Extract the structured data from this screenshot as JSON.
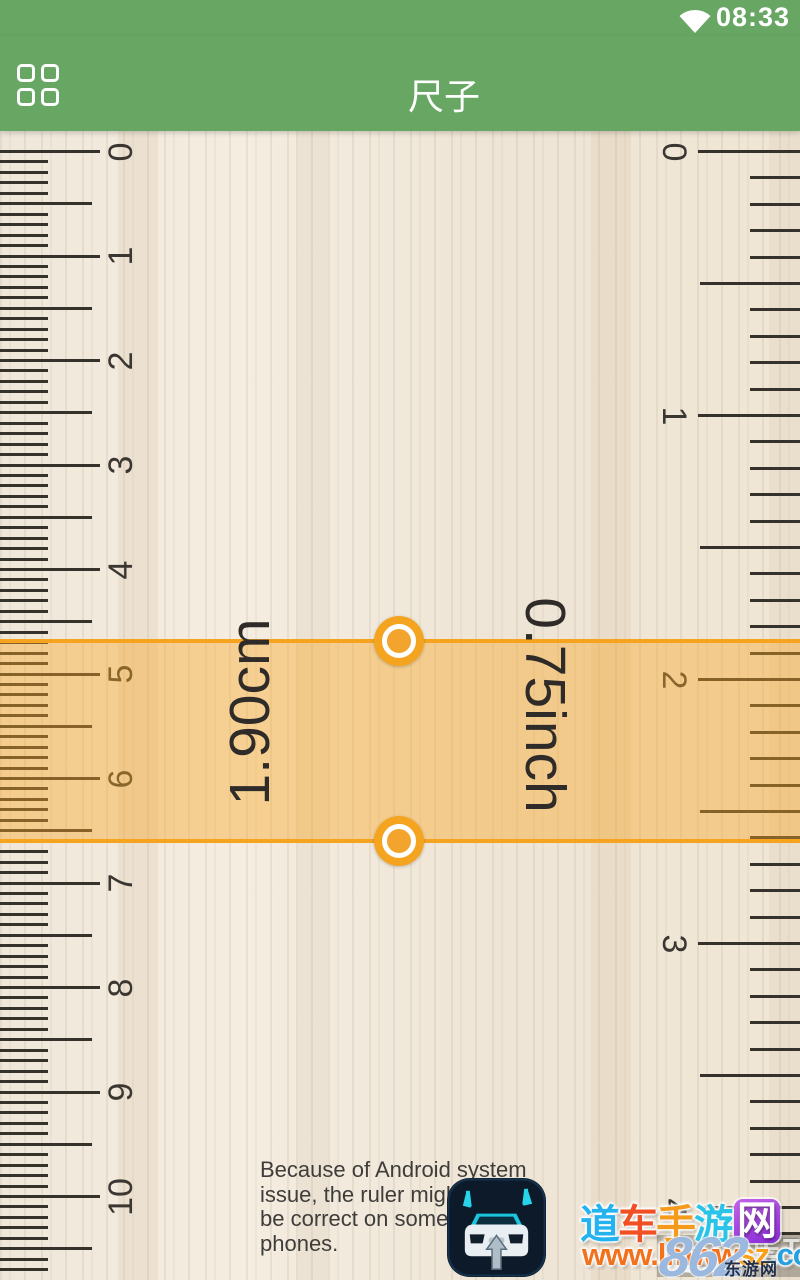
{
  "colors": {
    "header_green": "#68a763",
    "tick": "#35312b",
    "band_fill": "rgba(247,167,39,0.42)",
    "band_border": "#f6a41f",
    "handle_orange": "#f5a41f",
    "handle_inner_orange": "#f2a42c"
  },
  "status_bar": {
    "time": "08:33",
    "wifi_icon": "wifi-signal-icon"
  },
  "header": {
    "title": "尺子",
    "menu_icon": "grid-menu-icon"
  },
  "ruler": {
    "cm_scale": {
      "unit": "cm",
      "labels": [
        "0",
        "1",
        "2",
        "3",
        "4",
        "5",
        "6",
        "7",
        "8",
        "9",
        "10"
      ],
      "px_per_unit": 104.5,
      "minor_divisions": 10,
      "zero_y": 20.5,
      "len_major": 100,
      "len_half": 92,
      "len_minor": 48,
      "num_center": 121
    },
    "inch_scale": {
      "unit": "inch",
      "labels": [
        "0",
        "1",
        "2",
        "3",
        "4"
      ],
      "px_per_unit": 264,
      "minor_divisions": 10,
      "zero_y": 20.5,
      "len_major": 102,
      "len_half": 100,
      "len_minor": 50,
      "num_center": 674
    }
  },
  "measurement": {
    "cm_value": "1.90cm",
    "inch_value": "0.75inch",
    "band_top_y": 510,
    "band_height": 200,
    "handle_x": 399
  },
  "notice": {
    "lines": [
      "Because of Android system",
      "issue, the ruler might not",
      "be correct on some mobile",
      "phones."
    ]
  },
  "watermark": {
    "site_chars": [
      {
        "ch": "道",
        "color": "#25b3f0"
      },
      {
        "ch": "车",
        "color": "#f05023"
      },
      {
        "ch": "手",
        "color": "#f69a1b"
      },
      {
        "ch": "游",
        "color": "#2bc3e8"
      },
      {
        "ch": "网",
        "color": "#ffffff",
        "boxed": true
      }
    ],
    "url_segments": [
      {
        "text": "www.lmww",
        "color": "#f4711c"
      },
      {
        "text": "sz",
        "color": "#f9a01b"
      },
      {
        "text": ".com",
        "color": "#28a0e0"
      }
    ],
    "overlay_number": "862",
    "overlay_net": "NET",
    "overlay_site": "东游网"
  }
}
